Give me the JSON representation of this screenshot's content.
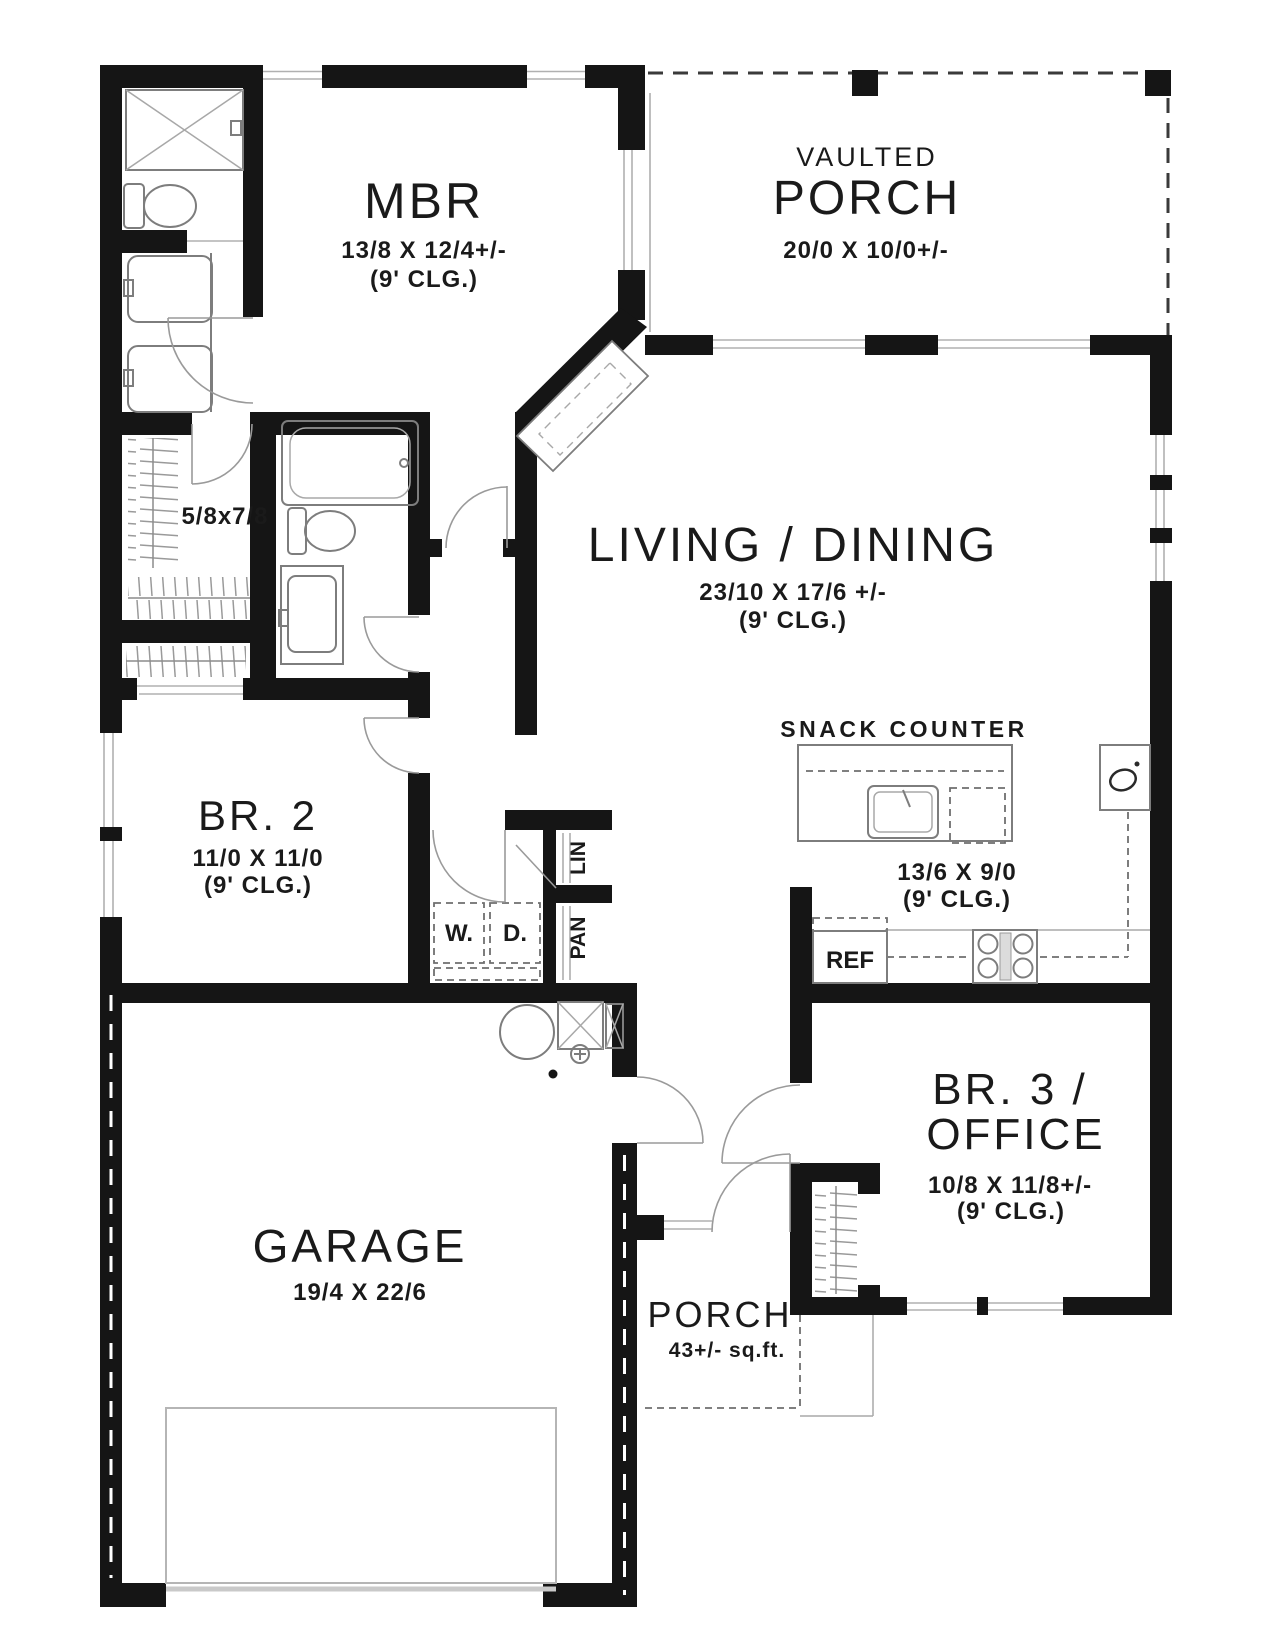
{
  "rooms": {
    "mbr": {
      "name": "MBR",
      "dim": "13/8 X 12/4+/-",
      "clg": "(9' CLG.)"
    },
    "vaulted_porch": {
      "prefix": "VAULTED",
      "name": "PORCH",
      "dim": "20/0 X 10/0+/-"
    },
    "living": {
      "name": "LIVING / DINING",
      "dim": "23/10 X 17/6 +/-",
      "clg": "(9' CLG.)"
    },
    "walkin_closet": {
      "name": "5/8x7/8"
    },
    "br2": {
      "name": "BR. 2",
      "dim": "11/0 X 11/0",
      "clg": "(9' CLG.)"
    },
    "kitchen": {
      "counter": "SNACK COUNTER",
      "dim": "13/6 X 9/0",
      "clg": "(9' CLG.)"
    },
    "br3": {
      "name_line1": "BR. 3 /",
      "name_line2": "OFFICE",
      "dim": "10/8 X 11/8+/-",
      "clg": "(9' CLG.)"
    },
    "garage": {
      "name": "GARAGE",
      "dim": "19/4 X 22/6"
    },
    "entry_porch": {
      "name": "PORCH",
      "dim": "43+/- sq.ft."
    }
  },
  "fixtures": {
    "fridge": "REF",
    "washer": "W.",
    "dryer": "D.",
    "pantry": "PAN",
    "linen": "LIN"
  }
}
